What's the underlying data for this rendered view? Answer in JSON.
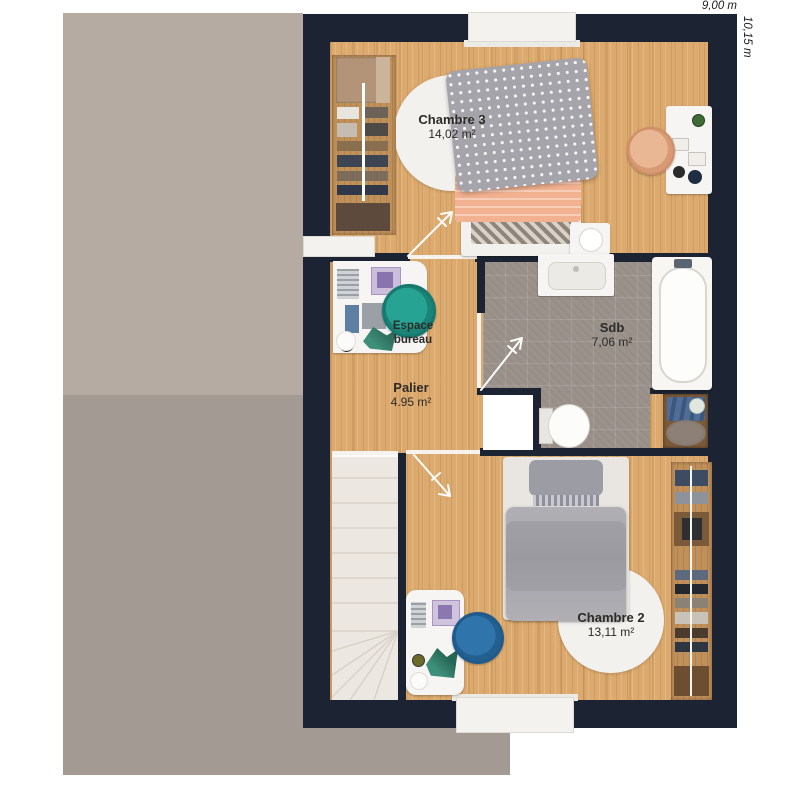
{
  "plan": {
    "dimensions": {
      "width_label": "9,00 m",
      "height_label": "10,15 m"
    },
    "rooms": {
      "chambre3": {
        "name": "Chambre 3",
        "area": "14,02 m²"
      },
      "espace_bureau": {
        "name": "Espace bureau"
      },
      "palier": {
        "name": "Palier",
        "area": "4.95 m²"
      },
      "sdb": {
        "name": "Sdb",
        "area": "7,06 m²"
      },
      "chambre2": {
        "name": "Chambre 2",
        "area": "13,11 m²"
      }
    }
  },
  "colors": {
    "wall": "#1c2433",
    "wood": "#dcaa6e",
    "wood_dark": "#c0905a",
    "tile": "#9a928b",
    "roof_upper": "#b5aba2",
    "roof_lower": "#a29a93",
    "rug": "#f3f1ee",
    "accent_teal": "#27a394",
    "accent_blue": "#2f74ab",
    "peach": "#f2b291",
    "duvet_gray": "#a3a2a8",
    "label_text": "#2c2a27"
  }
}
